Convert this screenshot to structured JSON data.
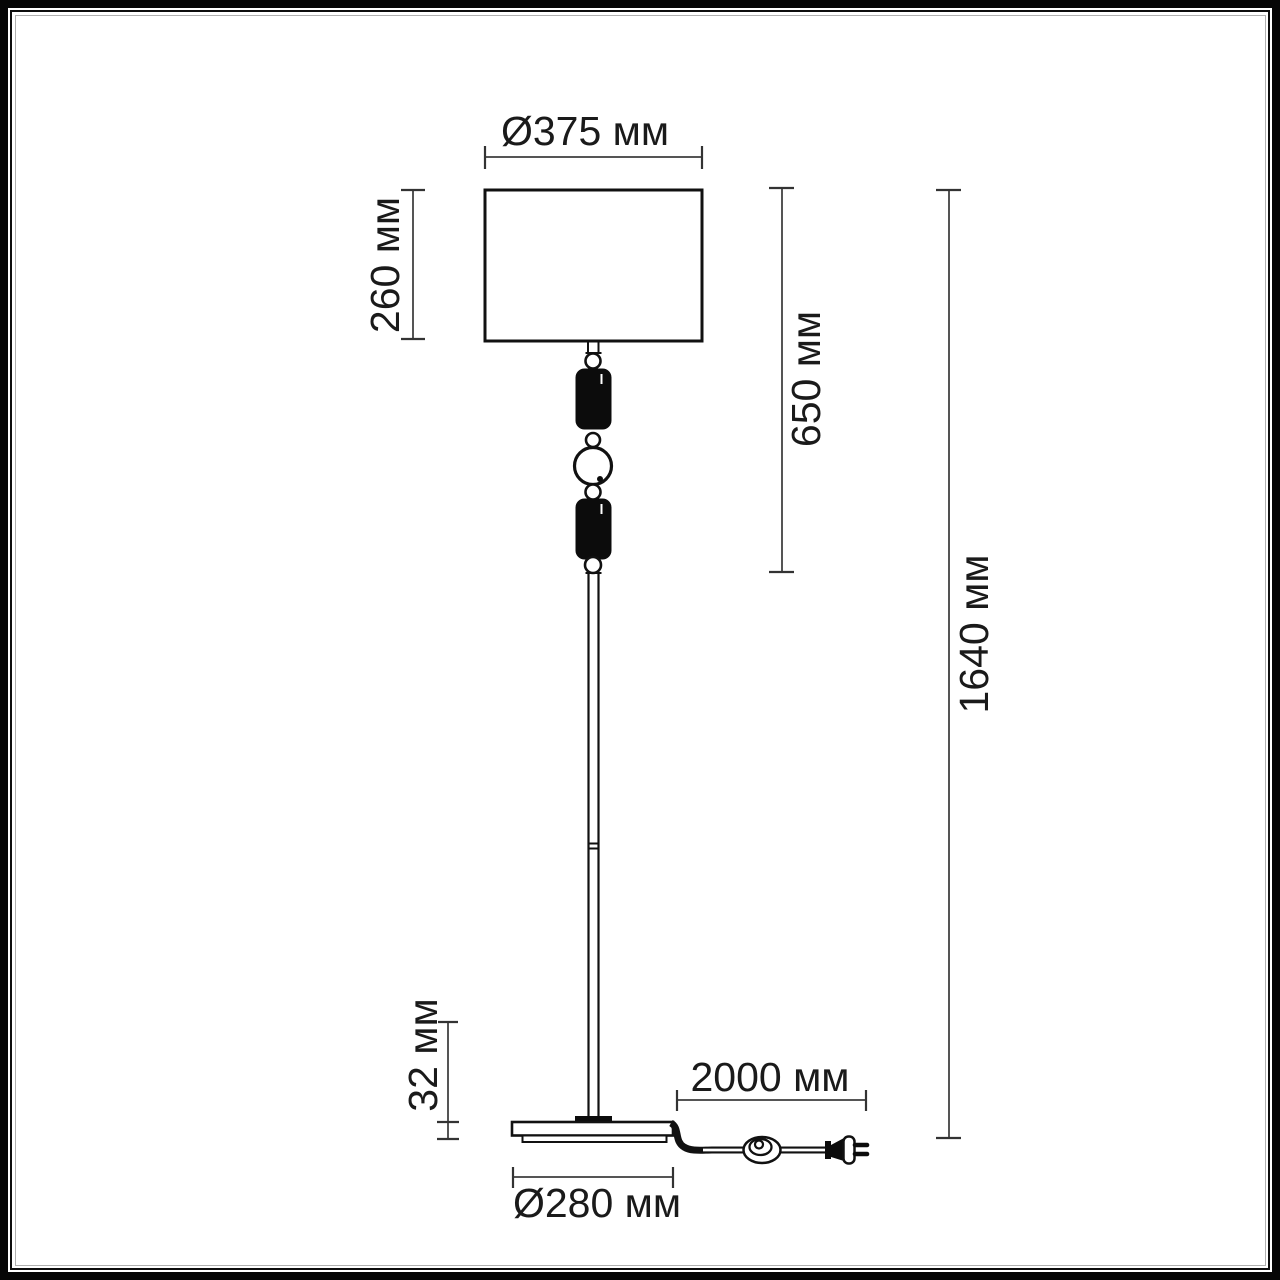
{
  "dimensions": {
    "shade_diameter": "Ø375 мм",
    "shade_height": "260 мм",
    "upper_section_height": "650 мм",
    "total_height": "1640 мм",
    "base_height": "32 мм",
    "cord_length": "2000 мм",
    "base_diameter": "Ø280 мм"
  },
  "colors": {
    "drawing_line": "#111111",
    "dimension_line": "#555555",
    "tick_line": "#333333",
    "text": "#1a1a1a",
    "background": "#ffffff"
  }
}
